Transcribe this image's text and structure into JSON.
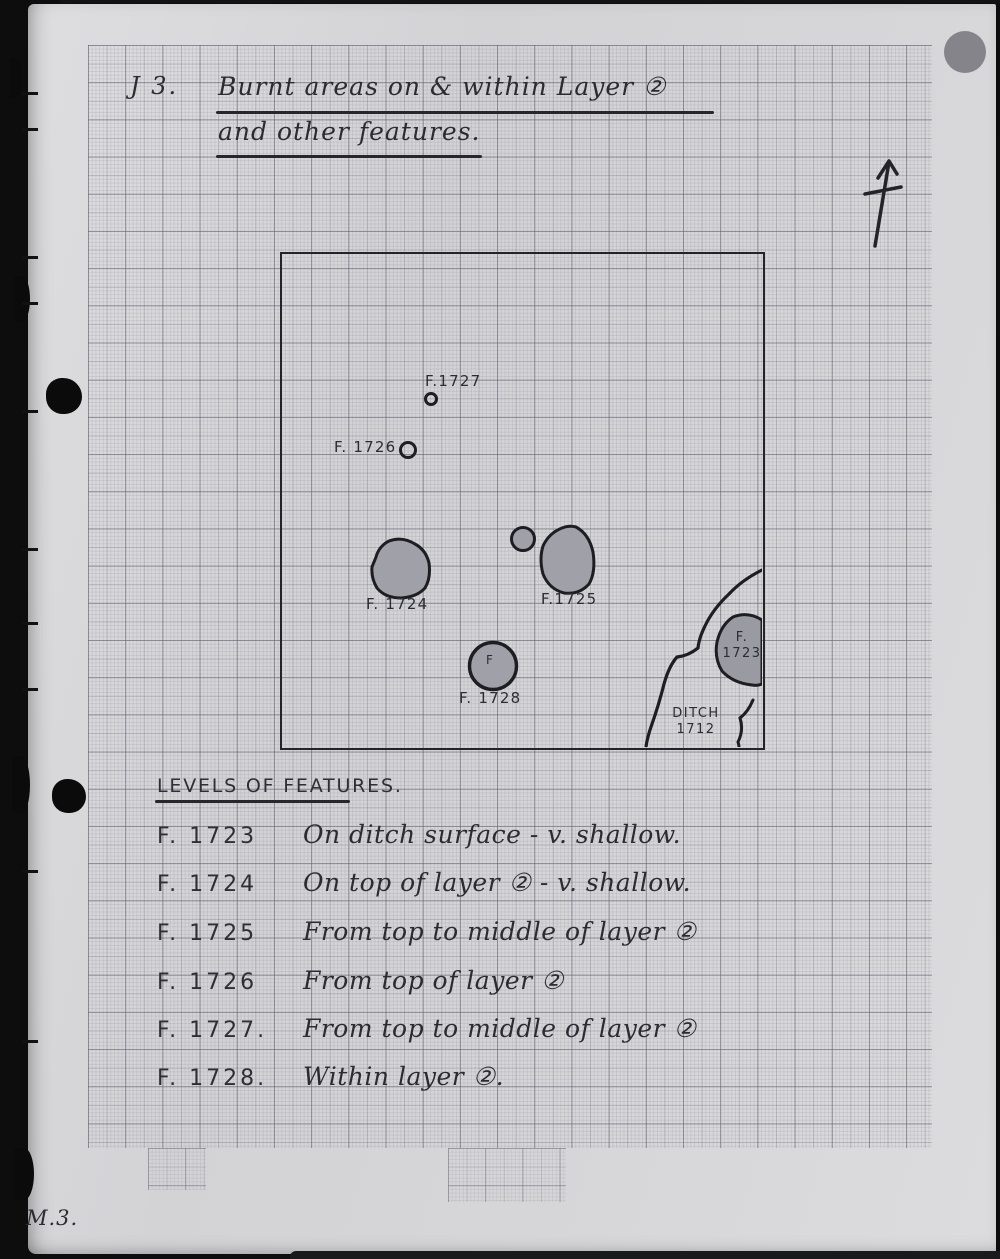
{
  "page": {
    "label": "J 3.",
    "title_line1": "Burnt areas on & within Layer ②",
    "title_line2": "and other features.",
    "page_number": "M.3.",
    "ink_color": "#26262b",
    "paper_color": "#d6d6d8",
    "feature_fill_color": "#a0a0a8"
  },
  "plan": {
    "labels": {
      "f1727": "F.1727",
      "f1726": "F. 1726",
      "f1724": "F. 1724",
      "f1725": "F.1725",
      "f1728": "F. 1728",
      "f1728_inner": "F",
      "f1723_line1": "F.",
      "f1723_line2": "1723",
      "ditch_line1": "DITCH",
      "ditch_line2": "1712"
    }
  },
  "levels": {
    "heading": "LEVELS OF FEATURES.",
    "rows": [
      {
        "id": "F. 1723",
        "desc": "On ditch surface - v. shallow."
      },
      {
        "id": "F. 1724",
        "desc": "On top of layer ② - v. shallow."
      },
      {
        "id": "F. 1725",
        "desc": "From top to middle of layer ②"
      },
      {
        "id": "F. 1726",
        "desc": "From top of layer ②"
      },
      {
        "id": "F. 1727.",
        "desc": "From top to middle of layer ②"
      },
      {
        "id": "F. 1728.",
        "desc": "Within layer ②."
      }
    ]
  }
}
